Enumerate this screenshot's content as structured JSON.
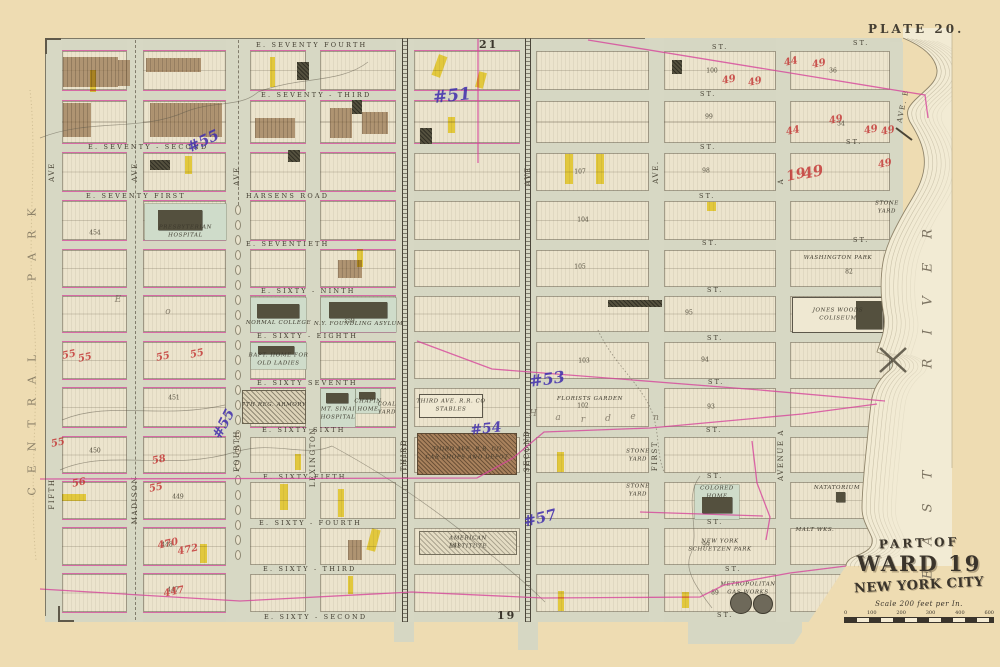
{
  "plate": {
    "label": "PLATE 20.",
    "adjacent_plate_top": "21",
    "adjacent_plate_bottom": "19"
  },
  "cartouche": {
    "line1": "PART OF",
    "line2": "WARD 19",
    "line3": "NEW YORK CITY",
    "scale_label": "Scale 200 feet per In.",
    "scale_ticks": [
      "0",
      "100",
      "200",
      "300",
      "400",
      "600"
    ]
  },
  "regions": {
    "park": "CENTRAL PARK",
    "river": "EAST RIVER"
  },
  "colors": {
    "paper": "#eedcb2",
    "sheet": "#d6d7c3",
    "block": "#ece4cd",
    "river": "#f2ebd4",
    "park_green": "#cfdcca",
    "pink": "#d6459b",
    "purple": "#4331ae",
    "red_ink": "#c53a38",
    "yellow": "#f2d719",
    "brown": "#9b7a54",
    "dark_building": "#54503e",
    "contour": "#9b8f72",
    "ink": "#433e31"
  },
  "grid": {
    "rows": [
      [
        51,
        39
      ],
      [
        101,
        42
      ],
      [
        153,
        38
      ],
      [
        201,
        39
      ],
      [
        250,
        37
      ],
      [
        296,
        36
      ],
      [
        342,
        37
      ],
      [
        388,
        39
      ],
      [
        437,
        36
      ],
      [
        482,
        37
      ],
      [
        528,
        37
      ],
      [
        574,
        38
      ]
    ],
    "cols": [
      [
        62,
        65,
        "W1"
      ],
      [
        143,
        83,
        "W2"
      ],
      [
        250,
        56,
        "W3"
      ],
      [
        320,
        76,
        "W4"
      ],
      [
        414,
        106,
        "C1"
      ],
      [
        536,
        113,
        "C2"
      ],
      [
        664,
        112,
        "E1"
      ],
      [
        790,
        100,
        "E2"
      ]
    ],
    "avenues": [
      {
        "id": "fifth",
        "x": 45,
        "w": 17,
        "style": "plain"
      },
      {
        "id": "madison",
        "x": 127,
        "w": 16,
        "style": "dash"
      },
      {
        "id": "fourth",
        "x": 226,
        "w": 24,
        "style": "ovals"
      },
      {
        "id": "lexington",
        "x": 306,
        "w": 14,
        "style": "plain"
      },
      {
        "id": "third",
        "x": 396,
        "w": 18,
        "style": "rail"
      },
      {
        "id": "second",
        "x": 520,
        "w": 16,
        "style": "rail"
      },
      {
        "id": "first",
        "x": 649,
        "w": 15,
        "style": "plain"
      },
      {
        "id": "avenue-a",
        "x": 776,
        "w": 14,
        "style": "plain"
      },
      {
        "id": "avenue-b",
        "x": 890,
        "w": 13,
        "style": "plain",
        "y": 42,
        "h": 212
      }
    ]
  },
  "street_labels": [
    {
      "text": "E. SEVENTY FOURTH",
      "x": 256,
      "y": 45
    },
    {
      "text": "ST.",
      "x": 712,
      "y": 47
    },
    {
      "text": "ST.",
      "x": 853,
      "y": 43
    },
    {
      "text": "E. SEVENTY - THIRD",
      "x": 261,
      "y": 95
    },
    {
      "text": "ST.",
      "x": 700,
      "y": 94
    },
    {
      "text": "E. SEVENTY - SECOND",
      "x": 88,
      "y": 147
    },
    {
      "text": "ST.",
      "x": 700,
      "y": 147
    },
    {
      "text": "ST.",
      "x": 846,
      "y": 142
    },
    {
      "text": "E. SEVENTY FIRST",
      "x": 86,
      "y": 196
    },
    {
      "text": "HARSENS ROAD",
      "x": 246,
      "y": 196
    },
    {
      "text": "ST.",
      "x": 699,
      "y": 196
    },
    {
      "text": "E. SEVENTIETH",
      "x": 246,
      "y": 244
    },
    {
      "text": "ST.",
      "x": 702,
      "y": 243
    },
    {
      "text": "ST.",
      "x": 853,
      "y": 240
    },
    {
      "text": "E. SIXTY - NINTH",
      "x": 261,
      "y": 291
    },
    {
      "text": "ST.",
      "x": 707,
      "y": 290
    },
    {
      "text": "E. SIXTY - EIGHTH",
      "x": 257,
      "y": 336
    },
    {
      "text": "ST.",
      "x": 707,
      "y": 338
    },
    {
      "text": "E. SIXTY SEVENTH",
      "x": 257,
      "y": 383
    },
    {
      "text": "ST.",
      "x": 708,
      "y": 382
    },
    {
      "text": "E. SIXTY SIXTH",
      "x": 262,
      "y": 430
    },
    {
      "text": "ST.",
      "x": 706,
      "y": 430
    },
    {
      "text": "E. SIXTY FIFTH",
      "x": 263,
      "y": 477
    },
    {
      "text": "ST.",
      "x": 707,
      "y": 476
    },
    {
      "text": "E. SIXTY - FOURTH",
      "x": 259,
      "y": 523
    },
    {
      "text": "ST.",
      "x": 707,
      "y": 522
    },
    {
      "text": "E. SIXTY - THIRD",
      "x": 263,
      "y": 569
    },
    {
      "text": "ST.",
      "x": 725,
      "y": 569
    },
    {
      "text": "E. SIXTY - SECOND",
      "x": 264,
      "y": 617
    },
    {
      "text": "ST.",
      "x": 717,
      "y": 615
    }
  ],
  "avenue_labels": [
    {
      "text": "AVE",
      "x": 52,
      "y": 172
    },
    {
      "text": "FIFTH",
      "x": 52,
      "y": 494
    },
    {
      "text": "AVE",
      "x": 135,
      "y": 172
    },
    {
      "text": "MADISON",
      "x": 135,
      "y": 500
    },
    {
      "text": "AVE",
      "x": 237,
      "y": 176
    },
    {
      "text": "FOURTH",
      "x": 237,
      "y": 451
    },
    {
      "text": "LEXINGTON",
      "x": 313,
      "y": 457
    },
    {
      "text": "THIRD",
      "x": 404,
      "y": 455
    },
    {
      "text": "AVE",
      "x": 528,
      "y": 176
    },
    {
      "text": "SECOND",
      "x": 527,
      "y": 451
    },
    {
      "text": "AVE.",
      "x": 656,
      "y": 172
    },
    {
      "text": "FIRST",
      "x": 655,
      "y": 456
    },
    {
      "text": "A",
      "x": 781,
      "y": 181
    },
    {
      "text": "AVENUE  A",
      "x": 781,
      "y": 455
    },
    {
      "text": "AVE. B",
      "x": 903,
      "y": 106,
      "rot": -78
    }
  ],
  "features": [
    {
      "id": "presbyterian-hospital",
      "label": "PRESBYTERIAN\nHOSPITAL",
      "x": 145,
      "y": 204,
      "w": 81,
      "h": 36,
      "kind": "green",
      "bld": [
        [
          158,
          210,
          44,
          20
        ]
      ],
      "ly": 232
    },
    {
      "id": "normal-college",
      "label": "NORMAL COLLEGE",
      "x": 251,
      "y": 298,
      "w": 55,
      "h": 34,
      "kind": "green",
      "bld": [
        [
          257,
          304,
          42,
          14
        ]
      ],
      "ly": 324
    },
    {
      "id": "foundling-asylum",
      "label": "N.Y. FOUNDLING ASYLUM",
      "x": 321,
      "y": 298,
      "w": 75,
      "h": 34,
      "kind": "green",
      "bld": [
        [
          329,
          302,
          58,
          16
        ]
      ],
      "ly": 325
    },
    {
      "id": "baptist-home",
      "label": "BAPT. HOME FOR\nOLD LADIES",
      "x": 251,
      "y": 343,
      "w": 55,
      "h": 26,
      "kind": "green",
      "bld": [
        [
          258,
          346,
          36,
          8
        ]
      ],
      "ly": 360
    },
    {
      "id": "seventh-regiment-armory",
      "label": "7TH REG. ARMORY",
      "x": 242,
      "y": 390,
      "w": 64,
      "h": 34,
      "kind": "hatch",
      "ly": 406
    },
    {
      "id": "mt-sinai-hospital",
      "label": "MT. SINAI\nHOSPITAL",
      "x": 321,
      "y": 389,
      "w": 34,
      "h": 38,
      "kind": "green",
      "bld": [
        [
          326,
          393,
          22,
          10
        ]
      ],
      "ly": 414
    },
    {
      "id": "chapin-home",
      "label": "CHAPIN\nHOME",
      "x": 356,
      "y": 389,
      "w": 24,
      "h": 24,
      "kind": "green",
      "bld": [
        [
          359,
          392,
          16,
          7
        ]
      ],
      "ly": 406
    },
    {
      "id": "coal-yard",
      "label": "COAL\nYARD",
      "x": 379,
      "y": 393,
      "w": 16,
      "h": 32,
      "kind": "plain",
      "ly": 409
    },
    {
      "id": "third-ave-rr-stables",
      "label": "THIRD AVE. R.R. CO\nSTABLES",
      "x": 419,
      "y": 394,
      "w": 64,
      "h": 24,
      "kind": "outline",
      "ly": 406
    },
    {
      "id": "third-ave-rr-car-shops",
      "label": "THIRD AVE. R.R. CO\nCAR SHOPS AND DEPOT",
      "x": 417,
      "y": 433,
      "w": 100,
      "h": 42,
      "kind": "brownhatch",
      "ly": 454
    },
    {
      "id": "american-institute",
      "label": "AMERICAN\nINSTITUTE",
      "x": 419,
      "y": 531,
      "w": 98,
      "h": 24,
      "kind": "lhatch",
      "ly": 543
    },
    {
      "id": "florists-garden",
      "label": "FLORISTS  GARDEN",
      "x": 545,
      "y": 394,
      "w": 90,
      "h": 12,
      "kind": "text",
      "ly": 400
    },
    {
      "id": "colored-home",
      "label": "COLORED\nHOME",
      "x": 695,
      "y": 485,
      "w": 44,
      "h": 34,
      "kind": "green",
      "bld": [
        [
          702,
          497,
          30,
          16
        ]
      ],
      "ly": 493
    },
    {
      "id": "schuetzen-park",
      "label": "NEW  YORK\nSCHUETZEN  PARK",
      "x": 666,
      "y": 530,
      "w": 108,
      "h": 32,
      "kind": "text",
      "ly": 546
    },
    {
      "id": "natatorium",
      "label": "NATATORIUM",
      "x": 815,
      "y": 484,
      "w": 44,
      "h": 14,
      "kind": "text",
      "bld": [
        [
          836,
          492,
          9,
          10
        ]
      ],
      "ly": 489
    },
    {
      "id": "metropolitan-gas-works",
      "label": "METROPOLITAN\nGAS WORKS",
      "x": 716,
      "y": 582,
      "w": 64,
      "h": 34,
      "kind": "plain",
      "ly": 589,
      "circles": [
        [
          741,
          603,
          11
        ],
        [
          763,
          604,
          10
        ]
      ]
    },
    {
      "id": "washington-park",
      "label": "WASHINGTON  PARK",
      "x": 793,
      "y": 252,
      "w": 90,
      "h": 18,
      "kind": "text",
      "ly": 259
    },
    {
      "id": "jones-woods-coliseum",
      "label": "JONES  WOODS\nCOLISEUM",
      "x": 792,
      "y": 297,
      "w": 92,
      "h": 36,
      "kind": "outline",
      "bld": [
        [
          856,
          301,
          26,
          28
        ]
      ],
      "ly": 315
    },
    {
      "id": "stone-yard-1",
      "label": "STONE\nYARD",
      "x": 625,
      "y": 448,
      "w": 26,
      "h": 16,
      "kind": "text",
      "ly": 456
    },
    {
      "id": "stone-yard-2",
      "label": "STONE\nYARD",
      "x": 625,
      "y": 483,
      "w": 26,
      "h": 16,
      "kind": "text",
      "ly": 491
    },
    {
      "id": "stone-yard-3",
      "label": "STONE\nYARD",
      "x": 874,
      "y": 200,
      "w": 26,
      "h": 16,
      "kind": "text",
      "ly": 208
    },
    {
      "id": "malt-works",
      "label": "MALT WKS.",
      "x": 795,
      "y": 527,
      "w": 40,
      "h": 10,
      "kind": "text",
      "ly": 531
    }
  ],
  "annotations": {
    "purple": [
      {
        "t": "#55",
        "x": 203,
        "y": 141,
        "r": -25,
        "s": 15
      },
      {
        "t": "#51",
        "x": 452,
        "y": 96,
        "r": -6,
        "s": 17
      },
      {
        "t": "#55",
        "x": 224,
        "y": 424,
        "r": -62,
        "s": 14
      },
      {
        "t": "#53",
        "x": 547,
        "y": 379,
        "r": -8,
        "s": 16
      },
      {
        "t": "#54",
        "x": 486,
        "y": 429,
        "r": -6,
        "s": 14
      },
      {
        "t": "#57",
        "x": 540,
        "y": 518,
        "r": -14,
        "s": 15
      }
    ],
    "red": [
      {
        "t": "49",
        "x": 729,
        "y": 80
      },
      {
        "t": "49",
        "x": 755,
        "y": 82
      },
      {
        "t": "44",
        "x": 791,
        "y": 62
      },
      {
        "t": "49",
        "x": 819,
        "y": 64
      },
      {
        "t": "49",
        "x": 836,
        "y": 120
      },
      {
        "t": "44",
        "x": 793,
        "y": 131
      },
      {
        "t": "49",
        "x": 871,
        "y": 130
      },
      {
        "t": "49",
        "x": 888,
        "y": 131
      },
      {
        "t": "19",
        "x": 796,
        "y": 175,
        "s": 14
      },
      {
        "t": "49",
        "x": 813,
        "y": 172,
        "s": 15
      },
      {
        "t": "49",
        "x": 885,
        "y": 164
      },
      {
        "t": "55",
        "x": 69,
        "y": 355
      },
      {
        "t": "55",
        "x": 85,
        "y": 358
      },
      {
        "t": "55",
        "x": 163,
        "y": 357
      },
      {
        "t": "55",
        "x": 197,
        "y": 354
      },
      {
        "t": "55",
        "x": 58,
        "y": 443
      },
      {
        "t": "58",
        "x": 159,
        "y": 460
      },
      {
        "t": "56",
        "x": 79,
        "y": 483
      },
      {
        "t": "55",
        "x": 156,
        "y": 488
      },
      {
        "t": "470",
        "x": 168,
        "y": 544
      },
      {
        "t": "472",
        "x": 188,
        "y": 550
      },
      {
        "t": "447",
        "x": 174,
        "y": 592
      }
    ]
  },
  "block_numbers": [
    [
      "100",
      712,
      71
    ],
    [
      "99",
      709,
      117
    ],
    [
      "98",
      706,
      171
    ],
    [
      "107",
      580,
      172
    ],
    [
      "104",
      583,
      220
    ],
    [
      "105",
      580,
      267
    ],
    [
      "103",
      584,
      361
    ],
    [
      "94",
      705,
      360
    ],
    [
      "102",
      583,
      406
    ],
    [
      "93",
      711,
      407
    ],
    [
      "95",
      689,
      313
    ],
    [
      "82",
      849,
      272
    ],
    [
      "36",
      833,
      71
    ],
    [
      "34",
      841,
      124
    ],
    [
      "89",
      715,
      593
    ],
    [
      "99",
      706,
      545
    ],
    [
      "450",
      95,
      451
    ],
    [
      "449",
      178,
      497
    ],
    [
      "448",
      167,
      545
    ],
    [
      "447",
      173,
      590
    ],
    [
      "454",
      95,
      233
    ],
    [
      "451",
      174,
      398
    ],
    [
      "359",
      349,
      321
    ],
    [
      "141",
      455,
      546
    ]
  ],
  "highlights": [
    [
      90,
      70,
      6,
      22,
      0
    ],
    [
      185,
      156,
      7,
      18,
      0
    ],
    [
      270,
      57,
      5,
      30,
      0
    ],
    [
      435,
      55,
      9,
      22,
      20
    ],
    [
      477,
      72,
      8,
      16,
      15
    ],
    [
      448,
      117,
      7,
      16,
      0
    ],
    [
      707,
      202,
      9,
      9,
      0
    ],
    [
      357,
      249,
      6,
      18,
      0
    ],
    [
      295,
      454,
      6,
      16,
      0
    ],
    [
      280,
      484,
      8,
      26,
      0
    ],
    [
      338,
      489,
      6,
      28,
      0
    ],
    [
      369,
      529,
      9,
      22,
      15
    ],
    [
      565,
      154,
      8,
      30,
      0
    ],
    [
      596,
      154,
      8,
      30,
      0
    ],
    [
      557,
      452,
      7,
      20,
      0
    ],
    [
      558,
      591,
      6,
      20,
      0
    ],
    [
      682,
      592,
      7,
      16,
      0
    ],
    [
      348,
      576,
      5,
      18,
      0
    ],
    [
      62,
      494,
      24,
      7,
      0
    ],
    [
      200,
      544,
      7,
      19,
      0
    ]
  ],
  "brown_patches": [
    [
      63,
      57,
      55,
      30
    ],
    [
      118,
      60,
      12,
      26
    ],
    [
      146,
      58,
      55,
      14
    ],
    [
      150,
      103,
      72,
      34
    ],
    [
      63,
      103,
      28,
      34
    ],
    [
      255,
      118,
      40,
      20
    ],
    [
      330,
      108,
      22,
      30
    ],
    [
      362,
      112,
      26,
      22
    ],
    [
      338,
      260,
      24,
      18
    ],
    [
      348,
      540,
      14,
      20
    ]
  ],
  "dark_buildings": [
    [
      297,
      62,
      12,
      18
    ],
    [
      352,
      100,
      10,
      14
    ],
    [
      420,
      128,
      12,
      16
    ],
    [
      608,
      300,
      54,
      7
    ],
    [
      672,
      60,
      10,
      14
    ],
    [
      150,
      160,
      20,
      10
    ],
    [
      288,
      150,
      12,
      12
    ]
  ],
  "script_letters": [
    [
      "H",
      533,
      414
    ],
    [
      "a",
      558,
      418
    ],
    [
      "r",
      583,
      420
    ],
    [
      "d",
      608,
      419
    ],
    [
      "e",
      633,
      417
    ],
    [
      "n",
      656,
      418
    ],
    [
      "E",
      118,
      300
    ],
    [
      "o",
      168,
      312
    ]
  ],
  "ink_lines": [
    {
      "d": "M40,138 C90,118 140,132 185,112 C215,100 240,108 258,92",
      "c": "farm"
    },
    {
      "d": "M258,92 C300,76 340,84 368,62",
      "c": "farm"
    },
    {
      "d": "M60,470 C110,448 170,472 235,452 C275,440 305,458 332,446",
      "c": "farm"
    },
    {
      "d": "M332,446 C380,472 430,505 475,542 C505,566 525,582 545,602",
      "c": "farm"
    },
    {
      "d": "M598,330 C612,362 642,385 652,412 C660,434 656,452 664,472",
      "c": "farmdot"
    },
    {
      "d": "M700,476 C682,500 702,530 690,556 C684,572 700,592 712,608",
      "c": "farm"
    },
    {
      "d": "M62,420 C110,400 160,420 225,405",
      "c": "farm"
    },
    {
      "d": "M30,90 C38,160 26,240 34,320 C40,400 28,480 36,560",
      "c": "parkpath"
    },
    {
      "d": "M588,40 L925,95 L928,118",
      "c": "pink"
    },
    {
      "d": "M478,39 L478,163",
      "c": "pink"
    },
    {
      "d": "M417,341 L492,369 L760,390 L885,401",
      "c": "pink"
    },
    {
      "d": "M40,479 L477,478 L513,458 L544,432 L650,428 L802,414 L877,404",
      "c": "pink"
    },
    {
      "d": "M40,589 L240,601 L412,592 L543,598 L700,597 L724,585 L790,573 L846,566",
      "c": "pink"
    },
    {
      "d": "M752,441 L757,483 L770,517 L766,540",
      "c": "pink"
    },
    {
      "d": "M640,512 L763,516",
      "c": "pink"
    }
  ]
}
